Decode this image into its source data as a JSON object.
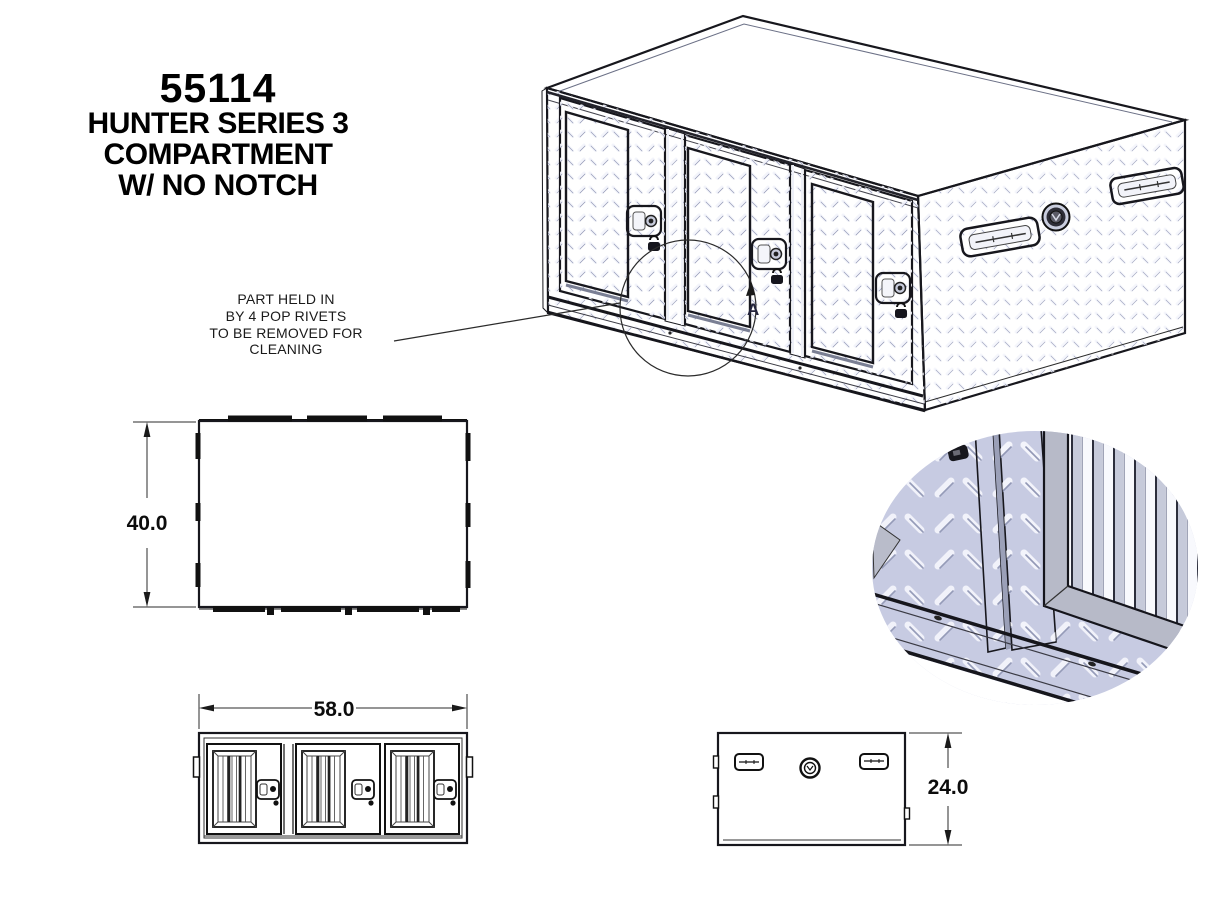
{
  "title_block": {
    "part_number": "55114",
    "line2": "HUNTER SERIES 3",
    "line3": "COMPARTMENT",
    "line4": "W/ NO NOTCH"
  },
  "note": {
    "line1": "PART HELD IN",
    "line2": "BY 4 POP RIVETS",
    "line3": "TO BE REMOVED FOR CLEANING"
  },
  "detail_callout": {
    "label": "A"
  },
  "dimensions": {
    "top_view_height": "40.0",
    "front_view_width": "58.0",
    "side_view_height": "24.0"
  },
  "colors": {
    "line": "#17171d",
    "front_face": "#c6cbe2",
    "top_face": "#c2c7dd",
    "side_face": "#e3e6f3",
    "bar_gray": "#b5bad2",
    "frame_gray": "#b7bac8",
    "divider": "#d4d7e8"
  }
}
